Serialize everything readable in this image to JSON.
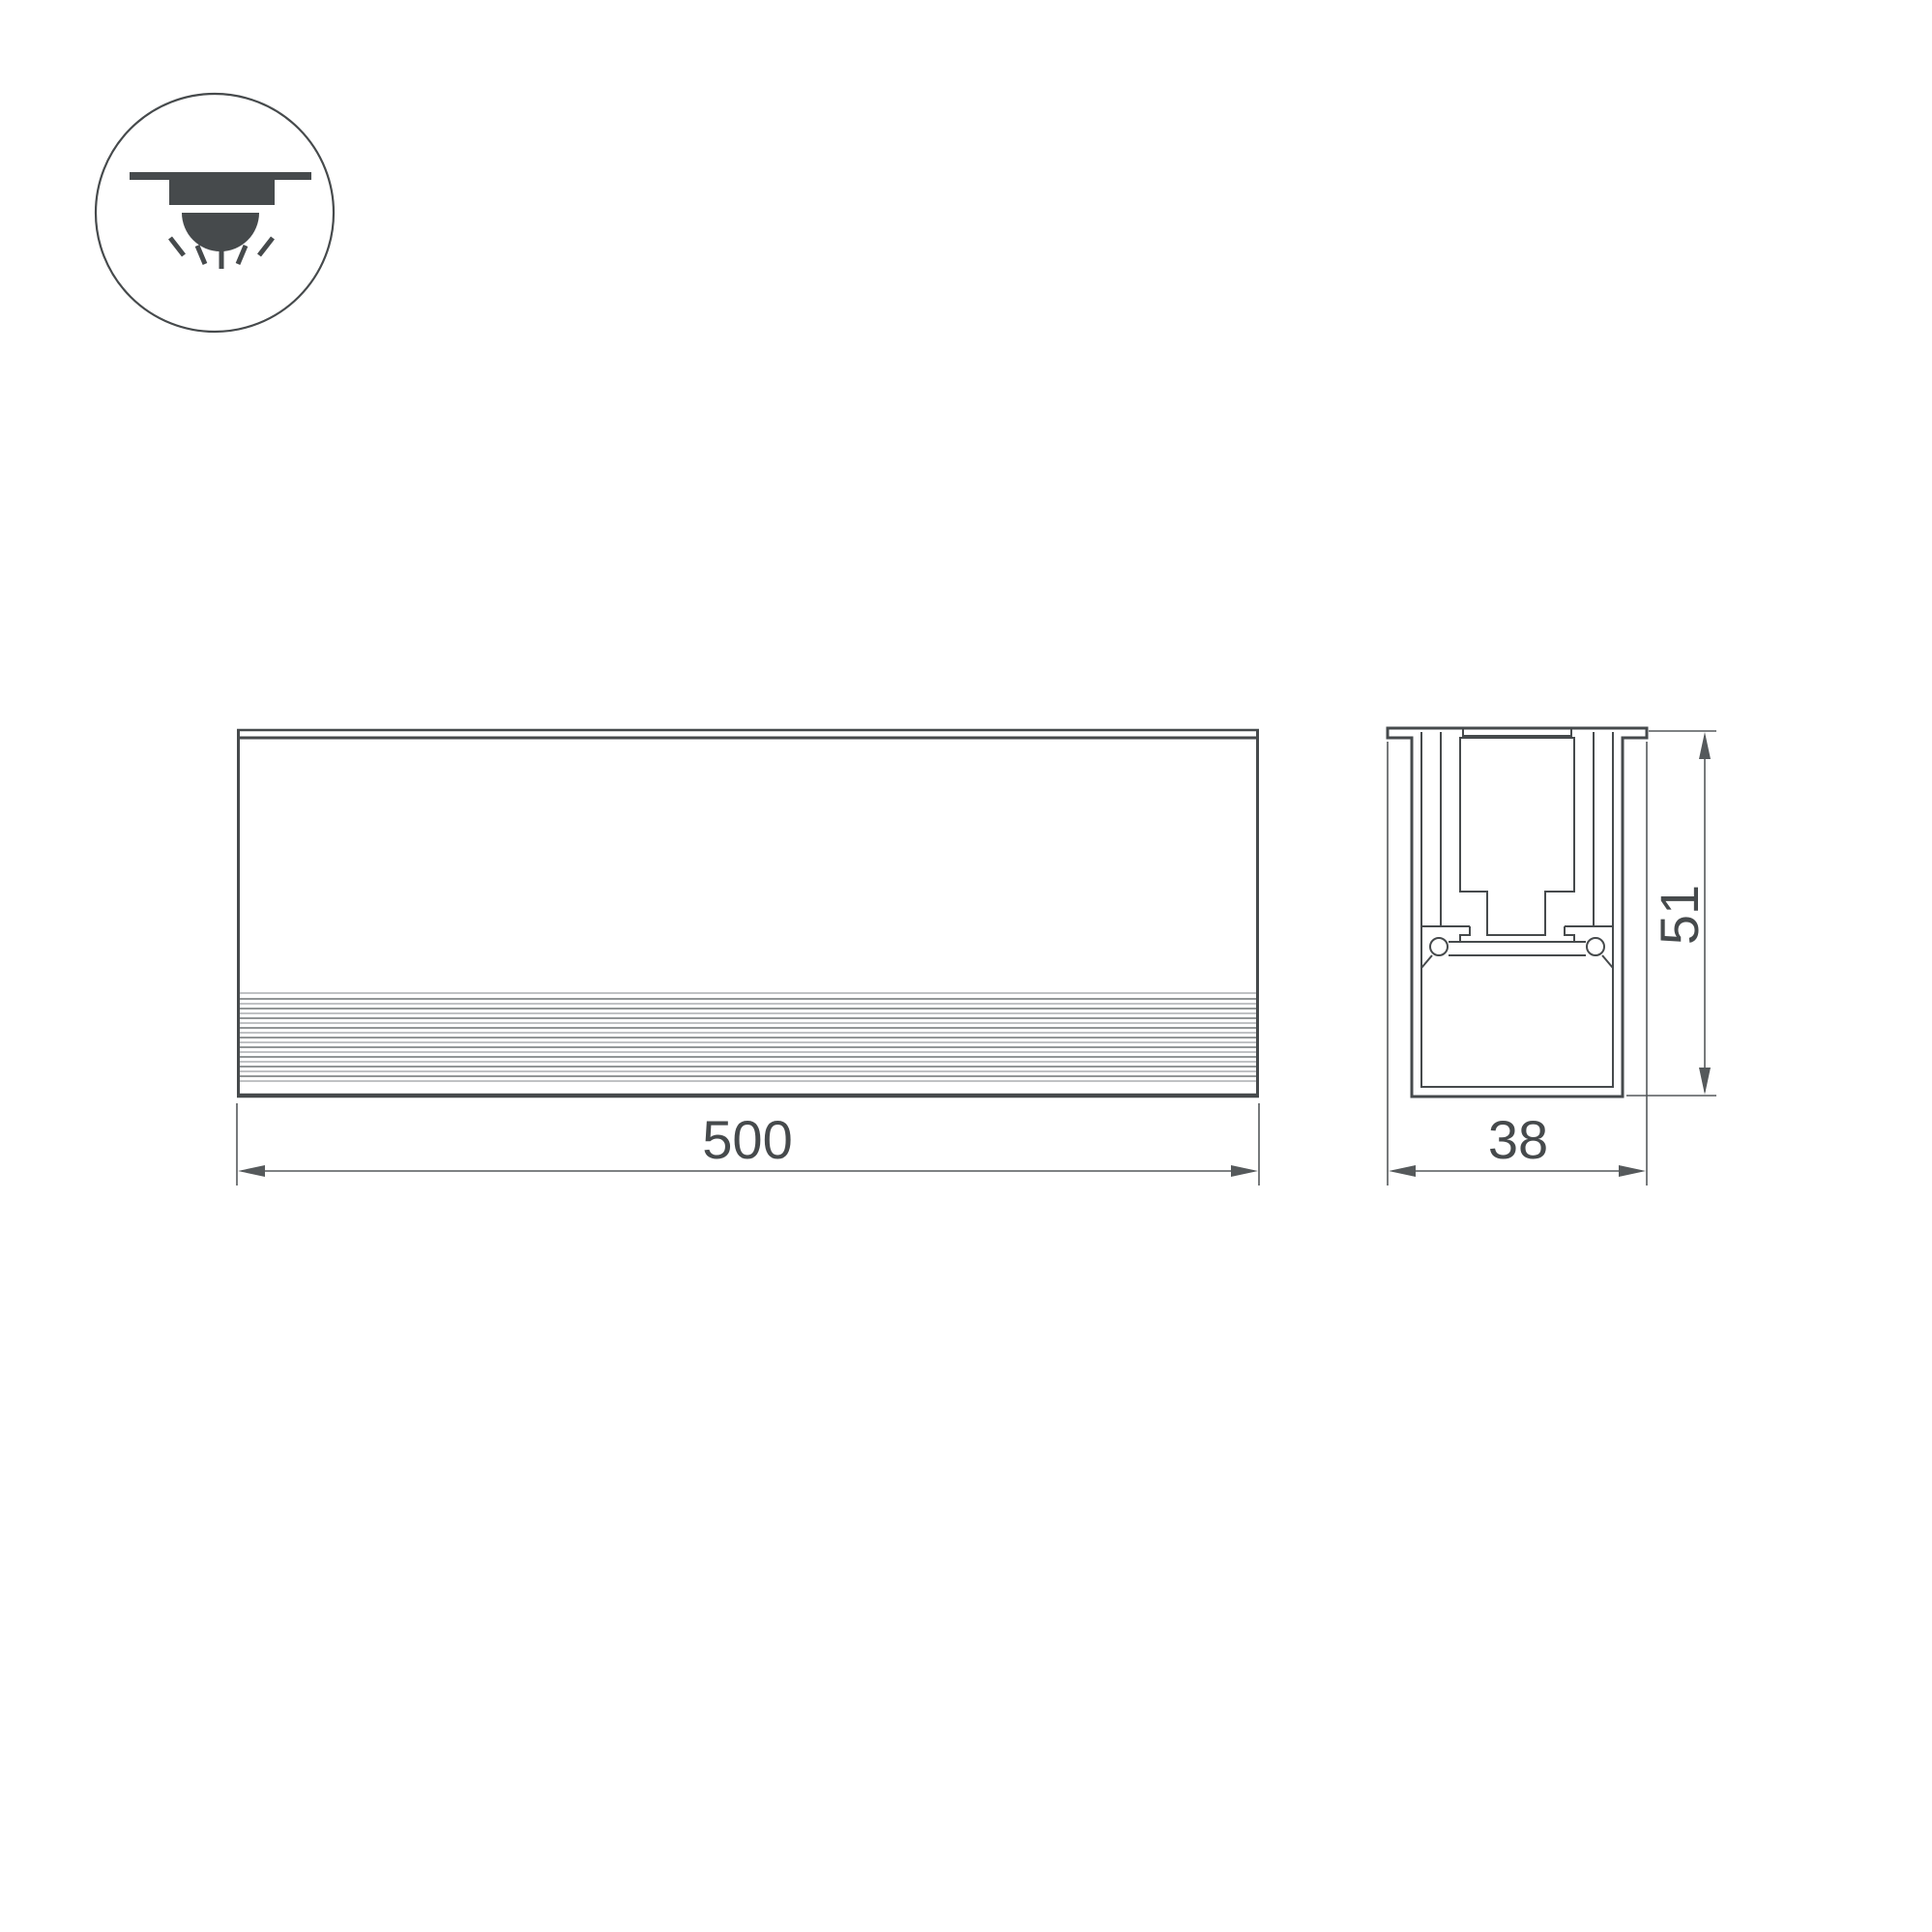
{
  "drawing": {
    "icon": {
      "type": "recessed-downlight"
    },
    "front_view": {
      "length": "500"
    },
    "section_view": {
      "width": "38",
      "height": "51"
    },
    "colors": {
      "line": "#464a4c",
      "dim": "#55595b",
      "rib_dark": "#6f7375",
      "rib_light": "#9a9ea0",
      "background": "#ffffff"
    }
  }
}
